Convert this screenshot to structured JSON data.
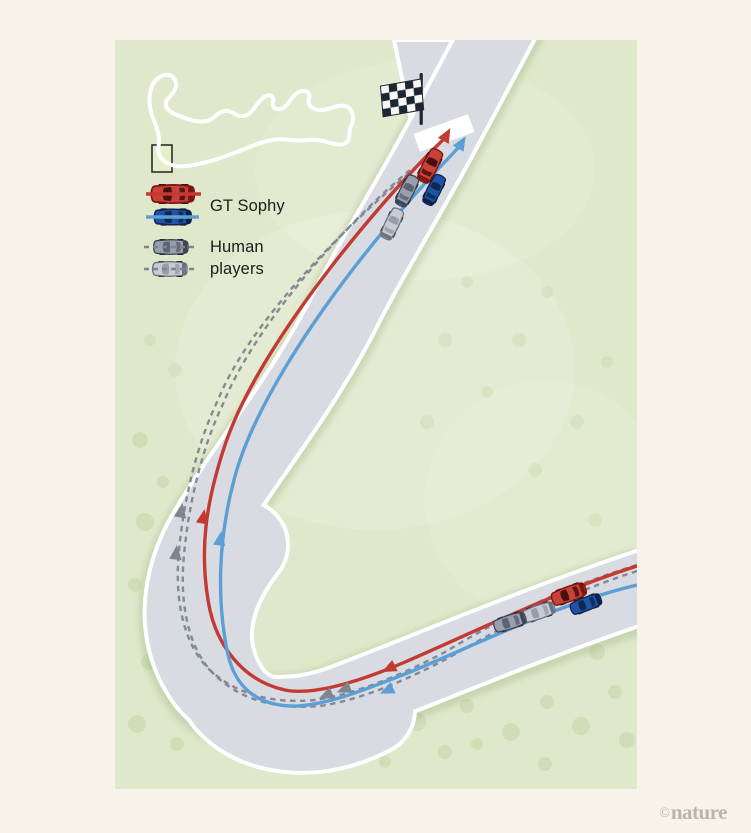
{
  "colors": {
    "page_bg": "#f7f3e8",
    "grass": "#dfe8ca",
    "grass_speckle": "#c2d4a4",
    "road": "#d9dbe3",
    "road_edge": "#ffffff",
    "sophy_red": "#c23a31",
    "sophy_blue": "#5b9fd4",
    "human_gray": "#7f8590",
    "ink": "#1c1c1c",
    "flag_dark": "#1d2533",
    "flag_white": "#f6f6f2",
    "nature_gray": "#b8b5ad",
    "highlight_box_stroke": "#2e2e2e",
    "highlight_box_fill": "#e6efc9",
    "car_palettes": {
      "red": {
        "body": "#c9423a",
        "outline": "#7f150e",
        "cabin": "#46100c"
      },
      "blue": {
        "body": "#1f53a5",
        "outline": "#101f49",
        "cabin": "#0d2850"
      },
      "dark_gray": {
        "body": "#98a0af",
        "outline": "#3e4554",
        "cabin": "#5c6472"
      },
      "light_gray": {
        "body": "#c6cbd4",
        "outline": "#6b7280",
        "cabin": "#979eab"
      }
    }
  },
  "legend": {
    "items": [
      {
        "label": "GT Sophy",
        "style": "solid",
        "colors": [
          "red",
          "blue"
        ]
      },
      {
        "label": "Human players",
        "style": "dashed",
        "colors": [
          "dark_gray",
          "light_gray"
        ]
      }
    ]
  },
  "icons": {
    "finish_flag": "checkered-flag",
    "circuit_map": "track-outline",
    "highlight_box": "corner-highlight"
  },
  "watermark": {
    "copyright": "©",
    "brand": "nature"
  },
  "scene": {
    "cars": [
      {
        "name": "sophy-red-finish",
        "palette": "red",
        "x": 315,
        "y": 126,
        "rot": 27,
        "scale": 0.82
      },
      {
        "name": "sophy-blue-finish",
        "palette": "blue",
        "x": 319,
        "y": 150,
        "rot": 27,
        "scale": 0.74
      },
      {
        "name": "human-dark-finish",
        "palette": "dark_gray",
        "x": 292,
        "y": 151,
        "rot": 27,
        "scale": 0.76
      },
      {
        "name": "human-light-finish",
        "palette": "light_gray",
        "x": 277,
        "y": 184,
        "rot": 26,
        "scale": 0.76
      },
      {
        "name": "sophy-red-entry",
        "palette": "red",
        "x": 454,
        "y": 554,
        "rot": 250,
        "scale": 0.82
      },
      {
        "name": "sophy-blue-entry",
        "palette": "blue",
        "x": 471,
        "y": 564,
        "rot": 249,
        "scale": 0.74
      },
      {
        "name": "human-light-entry",
        "palette": "light_gray",
        "x": 424,
        "y": 572,
        "rot": 251,
        "scale": 0.76
      },
      {
        "name": "human-dark-entry",
        "palette": "dark_gray",
        "x": 395,
        "y": 582,
        "rot": 252,
        "scale": 0.76
      },
      {
        "name": "legend-red",
        "palette": "red",
        "x": 58,
        "y": 154,
        "rot": -90,
        "scale": 1.0
      },
      {
        "name": "legend-blue",
        "palette": "blue",
        "x": 58,
        "y": 177,
        "rot": -90,
        "scale": 0.86
      },
      {
        "name": "legend-dark-gray",
        "palette": "dark_gray",
        "x": 56,
        "y": 207,
        "rot": -90,
        "scale": 0.8
      },
      {
        "name": "legend-light-gray",
        "palette": "light_gray",
        "x": 55,
        "y": 229,
        "rot": -90,
        "scale": 0.8
      }
    ]
  }
}
